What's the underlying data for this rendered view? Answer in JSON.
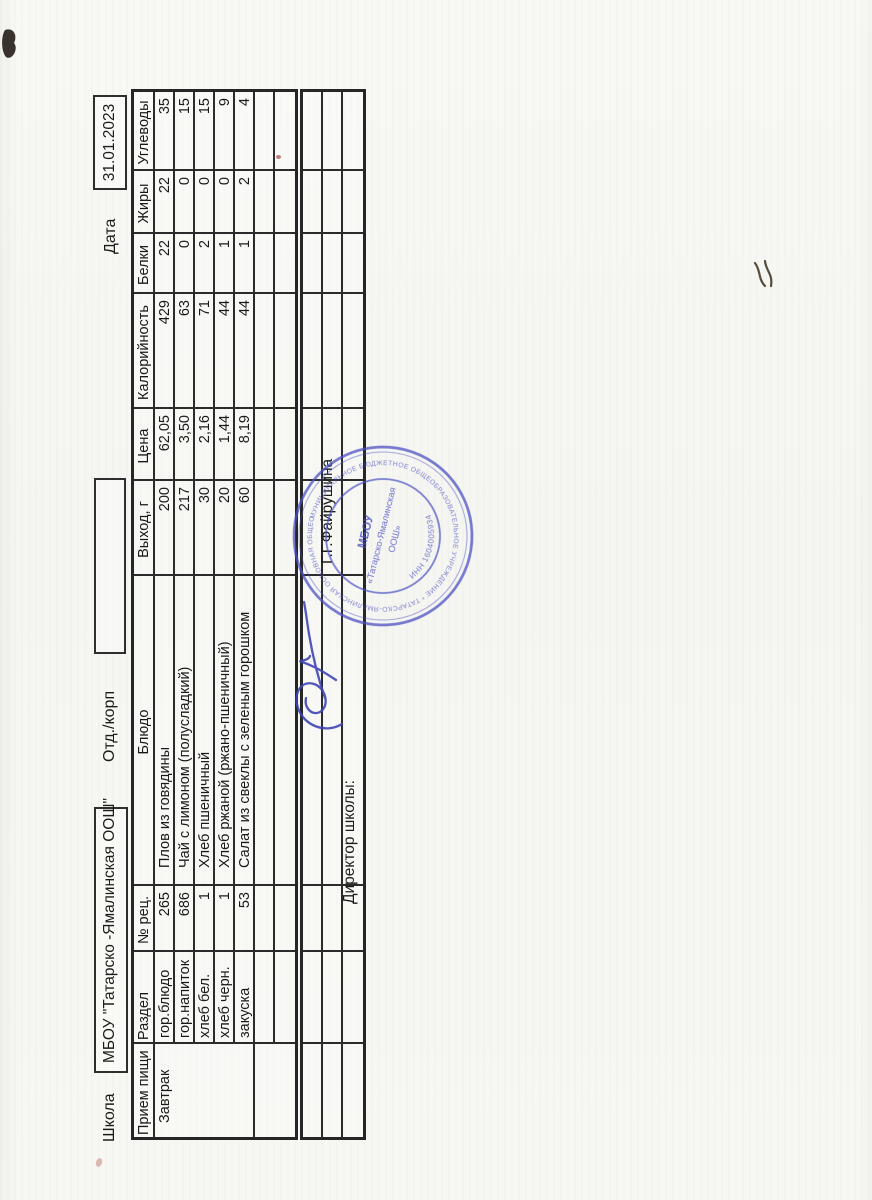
{
  "header": {
    "school_label": "Школа",
    "school_name": "МБОУ \"Татарско -Ямалинская ООШ\"",
    "dept_label": "Отд./корп",
    "dept_value": "",
    "date_label": "Дата",
    "date_value": "31.01.2023"
  },
  "menu_table": {
    "columns": [
      "Прием пищи",
      "Раздел",
      "№ рец.",
      "Блюдо",
      "Выход, г",
      "Цена",
      "Калорийность",
      "Белки",
      "Жиры",
      "Углеводы"
    ],
    "rows": [
      [
        "Завтрак",
        "гор.блюдо",
        "265",
        "Плов из говядины",
        "200",
        "62,05",
        "429",
        "22",
        "22",
        "35"
      ],
      [
        "",
        "гор.напиток",
        "686",
        "Чай с лимоном (полусладкий)",
        "217",
        "3,50",
        "63",
        "0",
        "0",
        "15"
      ],
      [
        "",
        "хлеб бел.",
        "1",
        "Хлеб пшеничный",
        "30",
        "2,16",
        "71",
        "2",
        "0",
        "15"
      ],
      [
        "",
        "хлеб черн.",
        "1",
        "Хлеб ржаной (ржано-пшеничный)",
        "20",
        "1,44",
        "44",
        "1",
        "0",
        "9"
      ],
      [
        "",
        "закуска",
        "53",
        "Салат из свеклы с зеленым горошком",
        "60",
        "8,19",
        "44",
        "1",
        "2",
        "4"
      ],
      [
        "",
        "",
        "",
        "",
        "",
        "",
        "",
        "",
        "",
        ""
      ],
      [
        "",
        "",
        "",
        "",
        "",
        "",
        "",
        "",
        "",
        ""
      ]
    ]
  },
  "footer_table": {
    "rows": [
      [
        "",
        "",
        "",
        "",
        "",
        "",
        "",
        "",
        "",
        ""
      ],
      [
        "",
        "",
        "",
        "",
        "",
        "",
        "",
        "",
        "",
        ""
      ],
      [
        "",
        "",
        "",
        "",
        "",
        "",
        "",
        "",
        "",
        ""
      ]
    ]
  },
  "signature_block": {
    "director_label": "Директор школы:",
    "director_name": "Г.Г.Файрушина"
  },
  "stamp": {
    "color": "#4b51c4",
    "org_line1": "МБОУ",
    "org_line2": "«Татарско-Ямалинская",
    "org_line3": "ООШ»",
    "inn": "ИНН 1604005934",
    "ring_text": "МУНИЦИПАЛЬНОЕ БЮДЖЕТНОЕ ОБЩЕОБРАЗОВАТЕЛЬНОЕ УЧРЕЖДЕНИЕ * ТАТАРСКО-ЯМАЛИНСКАЯ ОСНОВНАЯ ОБЩЕОБРАЗОВАТЕЛЬНАЯ ШКОЛА * РЕСПУБЛИКИ ТАТАРСТАН *"
  }
}
